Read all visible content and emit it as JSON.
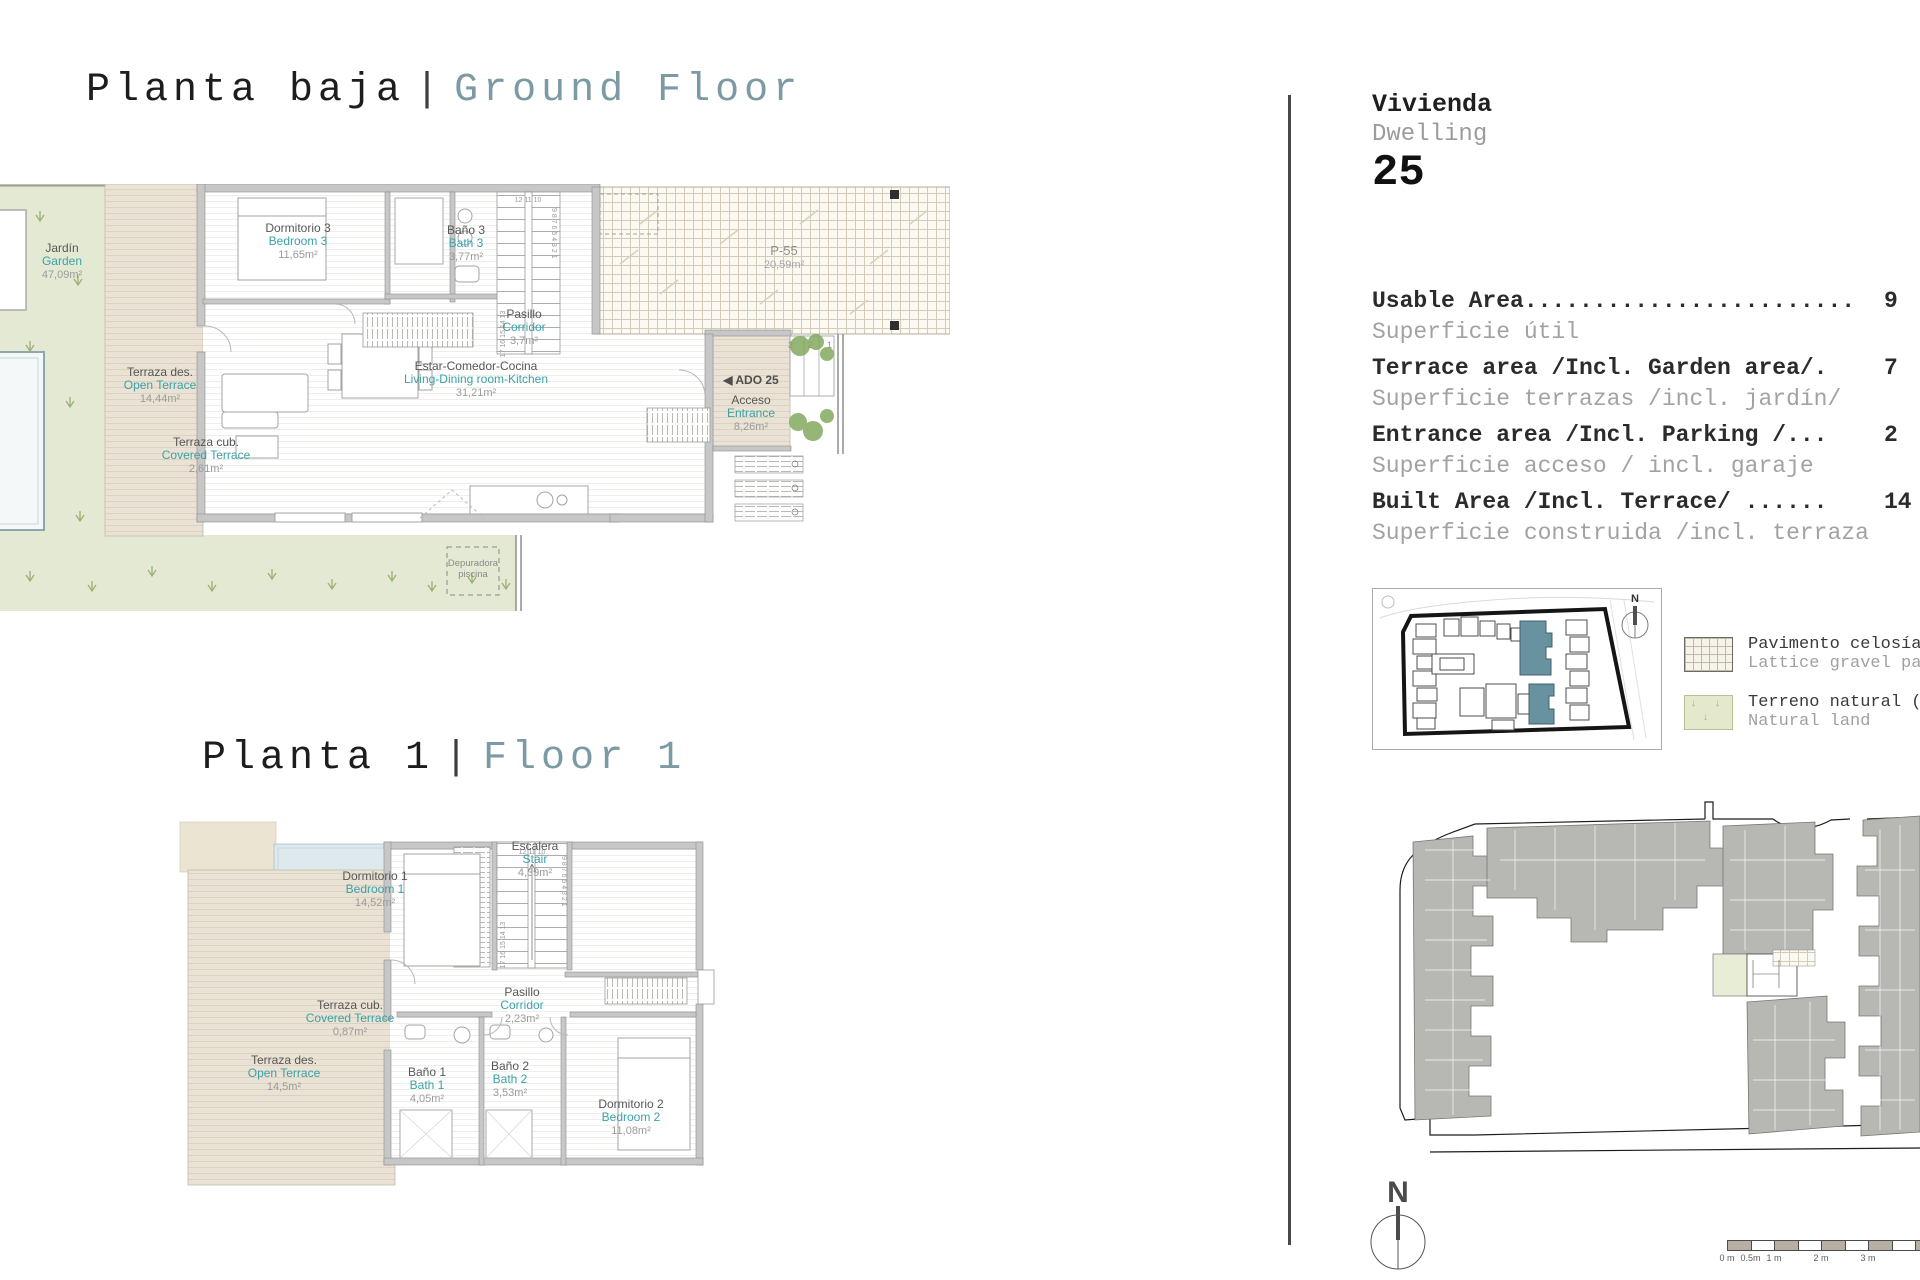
{
  "titles": {
    "ground": {
      "es": "Planta baja",
      "sep": "|",
      "en": "Ground Floor"
    },
    "floor1": {
      "es": "Planta 1",
      "sep": "|",
      "en": "Floor 1"
    }
  },
  "colors": {
    "accent_teal": "#3aa2a8",
    "title_teal": "#7b9aa4",
    "garden_green": "#e3e9d2",
    "terrace_tan": "#eae2d4",
    "site_highlight_teal": "#6992a0"
  },
  "ground": {
    "labels": {
      "jardin": {
        "es": "Jardín",
        "en": "Garden",
        "area": "47,09m²"
      },
      "dormitorio3": {
        "es": "Dormitorio 3",
        "en": "Bedroom 3",
        "area": "11,65m²"
      },
      "bano3": {
        "es": "Baño 3",
        "en": "Bath 3",
        "area": "3,77m²"
      },
      "pasillo": {
        "es": "Pasillo",
        "en": "Corridor",
        "area": "3,7m²"
      },
      "estar": {
        "es": "Estar-Comedor-Cocina",
        "en": "Living-Dining room-Kitchen",
        "area": "31,21m²"
      },
      "terraza_des": {
        "es": "Terraza des.",
        "en": "Open Terrace",
        "area": "14,44m²"
      },
      "terraza_cub": {
        "es": "Terraza cub.",
        "en": "Covered Terrace",
        "area": "2,61m²"
      },
      "acceso": {
        "es": "Acceso",
        "en": "Entrance",
        "area": "8,26m²"
      },
      "parking": {
        "label": "P-55",
        "area": "20,59m²"
      },
      "ado": {
        "label": "◀ ADO 25"
      },
      "depuradora": {
        "line1": "Depuradora",
        "line2": "piscina"
      }
    },
    "stairs": {
      "top": "12  11  10",
      "left": "17 16 15 14 13",
      "right": "9 8 7 6 5 4 3 2 1"
    },
    "entry_steps": "3 2 1"
  },
  "floor1": {
    "labels": {
      "dormitorio1": {
        "es": "Dormitorio 1",
        "en": "Bedroom 1",
        "area": "14,52m²"
      },
      "dormitorio2": {
        "es": "Dormitorio 2",
        "en": "Bedroom 2",
        "area": "11,08m²"
      },
      "bano1": {
        "es": "Baño 1",
        "en": "Bath 1",
        "area": "4,05m²"
      },
      "bano2": {
        "es": "Baño 2",
        "en": "Bath 2",
        "area": "3,53m²"
      },
      "pasillo": {
        "es": "Pasillo",
        "en": "Corridor",
        "area": "2,23m²"
      },
      "escalera": {
        "es": "Escalera",
        "en": "Stair",
        "area": "4,39m²"
      },
      "terraza_des": {
        "es": "Terraza des.",
        "en": "Open Terrace",
        "area": "14,5m²"
      },
      "terraza_cub": {
        "es": "Terraza cub.",
        "en": "Covered Terrace",
        "area": "0,87m²"
      }
    },
    "stairs": {
      "top": "12  11  10",
      "left": "17 16 15 14 13",
      "right": "9 8 7 6 5 4 3 2 1"
    }
  },
  "panel": {
    "dwelling": {
      "es": "Vivienda",
      "en": "Dwelling",
      "number": "25"
    },
    "areas": [
      {
        "en": "Usable Area........................",
        "es": "Superficie útil",
        "value": "9"
      },
      {
        "en": "Terrace area /Incl. Garden area/.",
        "es": "Superficie terrazas /incl. jardín/",
        "value": "7"
      },
      {
        "en": "Entrance area /Incl. Parking /...",
        "es": "Superficie acceso / incl. garaje",
        "value": "2"
      },
      {
        "en": "Built Area /Incl. Terrace/ ......",
        "es": "Superficie construida /incl. terraza",
        "value": "14"
      }
    ],
    "legend": [
      {
        "es": "Pavimento celosía",
        "en": "Lattice gravel pa"
      },
      {
        "es": "Terreno natural (",
        "en": "Natural land"
      }
    ],
    "compass": "N",
    "scalebar": [
      "0 m",
      "0.5m",
      "1 m",
      "2 m",
      "3 m"
    ]
  },
  "minimap": {
    "compass": "N"
  }
}
